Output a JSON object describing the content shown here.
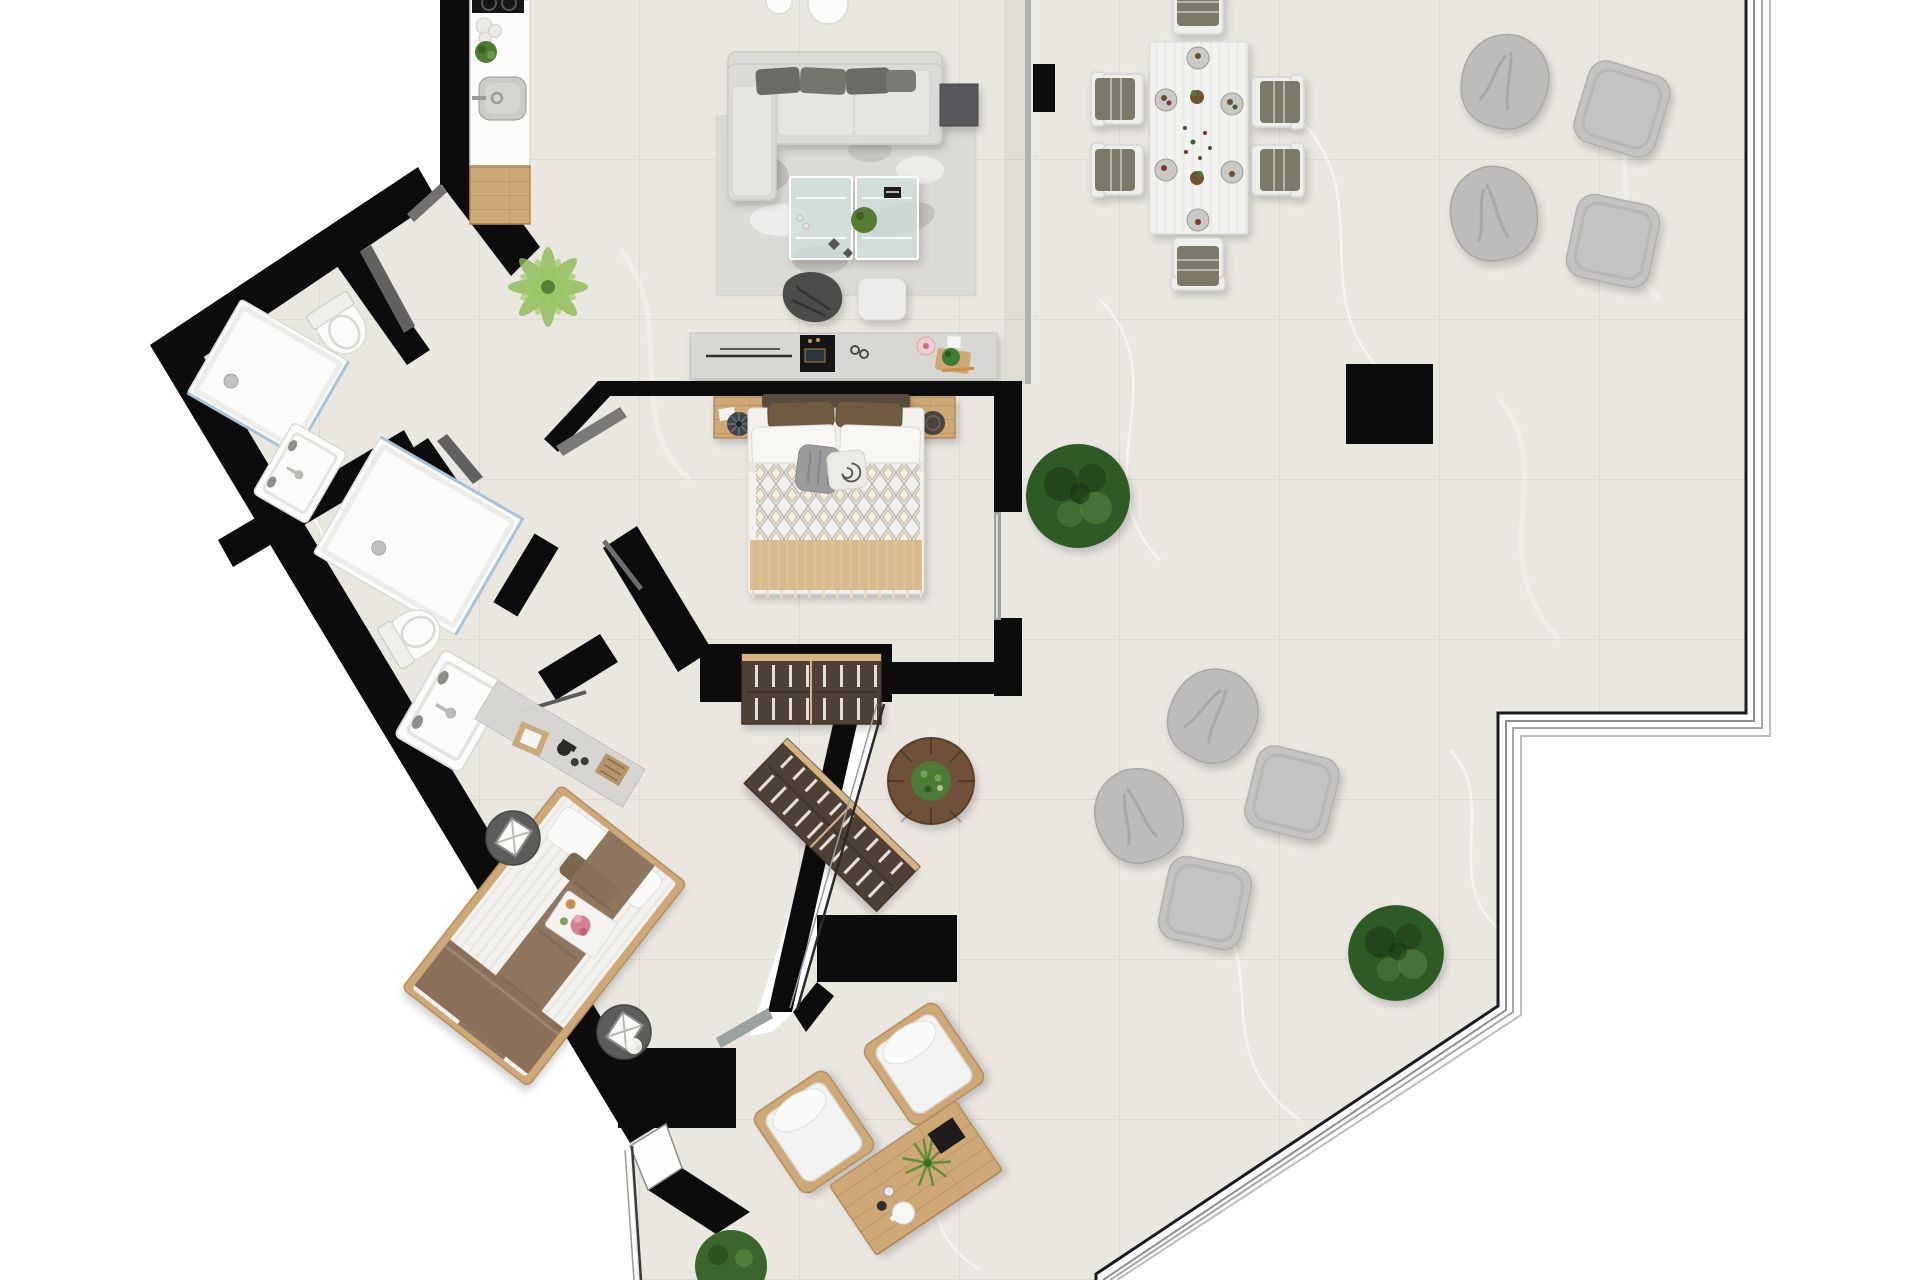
{
  "scene": {
    "type": "apartment-floor-plan",
    "view": "top-down-3d-render",
    "canvas": {
      "width_px": 1920,
      "height_px": 1280
    }
  },
  "colors": {
    "wall": "#0c0c0c",
    "floor": "#eae7e1",
    "outside": "#ffffff",
    "porcelain": "#fbfbf9",
    "wood": "#cfa878",
    "wood-dark": "#4e4136",
    "olive": "#7b7968",
    "chair-white": "#eeefed",
    "sofa": "#dcdbd8",
    "rug": "#dcdad6",
    "tan": "#d9ba8c",
    "brown": "#8a7058",
    "pouf": "#bdbcba",
    "pouf2": "#c4c3c1",
    "tree": "#2f5a26",
    "palm": "#8cbb55",
    "planter": "#6e5137",
    "door": "#72716f",
    "glassdoor": "#9aa19f",
    "glassblue": "#a8c2da",
    "railing": "#8e8e8c"
  },
  "rooms": {
    "kitchen": {
      "label": "Kitchen",
      "items": [
        "counter with cooktop",
        "sink",
        "herb plant",
        "storage jars",
        "wood worktop"
      ]
    },
    "living_room": {
      "label": "Living room",
      "items": [
        "corner sofa with dark cushions",
        "dark side table",
        "shaggy rug",
        "glass coffee table",
        "table plant",
        "book",
        "throw blanket",
        "white pouf",
        "palm plant",
        "sideboard with TV and decor"
      ]
    },
    "bedroom_1": {
      "label": "Bedroom 1",
      "items": [
        "double bed with patterned quilt and tan blanket",
        "wood nightstand left",
        "wood nightstand right",
        "slatted wardrobe"
      ]
    },
    "bathroom_1": {
      "label": "Bathroom 1",
      "items": [
        "shower",
        "toilet",
        "washbasin"
      ]
    },
    "bathroom_2": {
      "label": "Bathroom 2",
      "items": [
        "large shower",
        "toilet",
        "washbasin"
      ]
    },
    "bedroom_2": {
      "label": "Bedroom 2",
      "items": [
        "double bed with brown runner",
        "round side table upper",
        "round side table lower with flowers",
        "dressing console",
        "breakfast tray with roses",
        "slatted wardrobe angled"
      ]
    },
    "terrace": {
      "label": "Terrace",
      "items": [
        "dining table with six chairs and place settings",
        "four bean bags",
        "four square poufs",
        "structural pillar",
        "black column",
        "two round trees",
        "round planter with shrub",
        "two outdoor armchairs",
        "outdoor wood coffee table with plant and tea set",
        "glass wall",
        "glass sliding doors",
        "perimeter railing",
        "small bush at bottom edge"
      ]
    }
  },
  "counts": {
    "bedrooms": 2,
    "bathrooms": 2,
    "dining_chairs": 6,
    "place_settings": 6,
    "bean_bags": 4,
    "square_poufs": 4,
    "trees": 2,
    "outdoor_armchairs": 2,
    "showers": 2,
    "toilets": 2,
    "washbasins": 2,
    "wardrobes": 2
  }
}
